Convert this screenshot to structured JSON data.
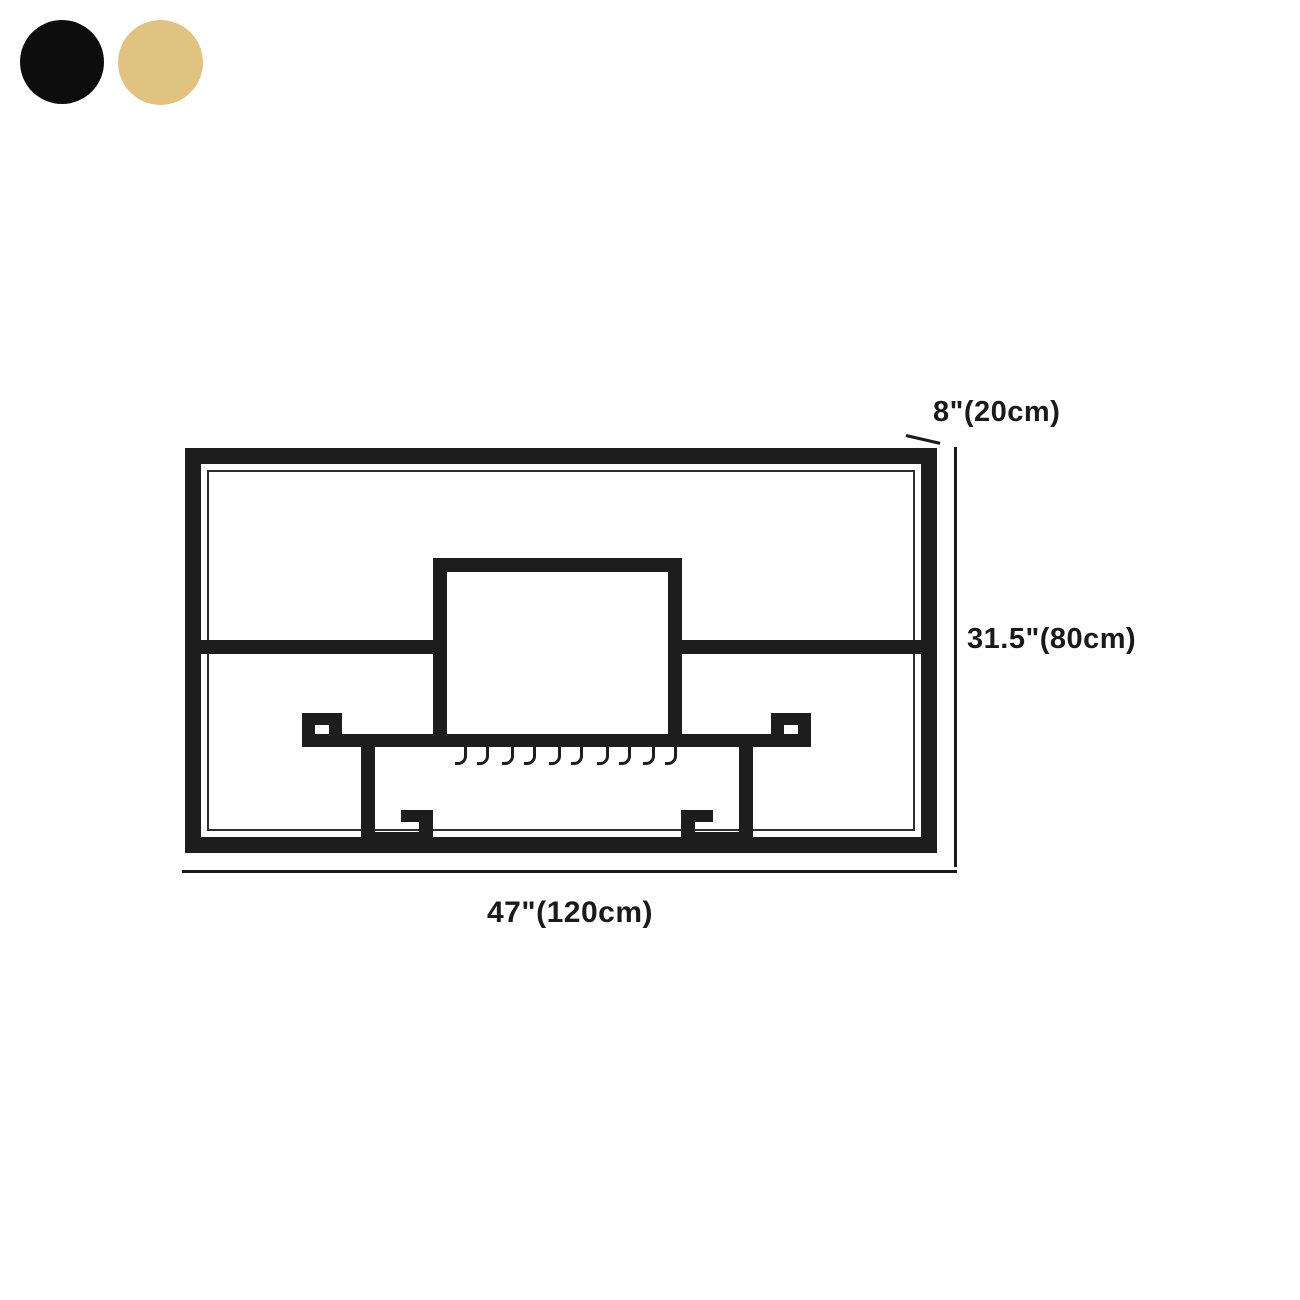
{
  "page": {
    "background": "#ffffff"
  },
  "color_swatches": {
    "items": [
      {
        "name": "black",
        "color": "#0d0d0d"
      },
      {
        "name": "gold",
        "color": "#e0c381"
      }
    ]
  },
  "diagram": {
    "frame_color": "#1d1d1d",
    "annotation_color": "#1a1a1a",
    "labels": {
      "depth": "8\"(20cm)",
      "height": "31.5\"(80cm)",
      "width": "47\"(120cm)"
    },
    "glass_hook_count": 10
  }
}
